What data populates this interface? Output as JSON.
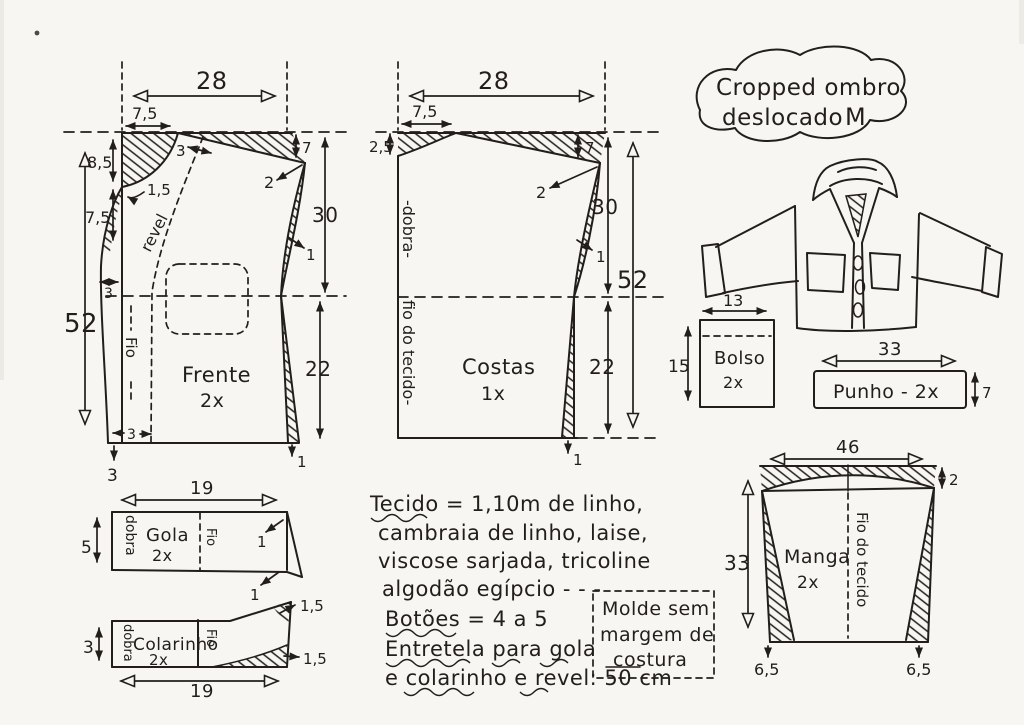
{
  "doc": {
    "bg": "#f7f6f2",
    "ink": "#221f1b",
    "kind": "hand-drawn sewing pattern sheet"
  },
  "title": {
    "line1": "Cropped ombro",
    "line2": "deslocado",
    "size": "M"
  },
  "frente": {
    "name": "Frente",
    "qty": "2x",
    "width": "28",
    "shoulder": "7,5",
    "shoulder_shift": "3",
    "neck_depth": "8,5",
    "neck_curve": "1,5",
    "front_drop": "7,5",
    "revel": "revel",
    "grain": "Fio",
    "length": "52",
    "drop_right": "7",
    "shift_note": "2",
    "armhole_len": "30",
    "ease_mid": "1",
    "side_len": "22",
    "front_ext": "3",
    "hem_ext": "3",
    "hem_drop": "3",
    "hem_ease": "1"
  },
  "costas": {
    "name": "Costas",
    "qty": "1x",
    "width": "28",
    "shoulder": "7,5",
    "neck_depth": "2,5",
    "drop_right": "7",
    "shift_note": "2",
    "armhole_len": "30",
    "length": "52",
    "side_len": "22",
    "ease_mid": "1",
    "hem_ease": "1",
    "fold": "-dobra-",
    "grain": "fio do tecido-"
  },
  "gola": {
    "name": "Gola",
    "qty": "2x",
    "width": "19",
    "height": "5",
    "fold": "dobra",
    "grain": "Fio",
    "tip_top": "1",
    "tip_bottom": "1"
  },
  "colarinho": {
    "name": "Colarinho",
    "qty": "2x",
    "height": "3",
    "width": "19",
    "fold": "dobra",
    "grain": "Fio",
    "rise_top": "1,5",
    "rise_bottom": "1,5"
  },
  "bolso": {
    "name": "Bolso",
    "qty": "2x",
    "width": "13",
    "height": "15"
  },
  "punho": {
    "label": "Punho - 2x",
    "width": "33",
    "height": "7"
  },
  "manga": {
    "name": "Manga",
    "qty": "2x",
    "width": "46",
    "cap_depth": "2",
    "height": "33",
    "grain": "Fio do tecido",
    "slant_left": "6,5",
    "slant_right": "6,5"
  },
  "notes": {
    "fabric1": "Tecido = 1,10m de linho,",
    "fabric2": "cambraia de linho, laise,",
    "fabric3": "viscose sarjada, tricoline",
    "fabric4": "algodão egípcio - - -",
    "buttons": "Botões = 4 a 5",
    "interfacing1": "Entretela para gola",
    "interfacing2": "e colarinho e revel: 50 cm",
    "box1": "Molde sem",
    "box2": "margem de",
    "box3": "costura"
  }
}
